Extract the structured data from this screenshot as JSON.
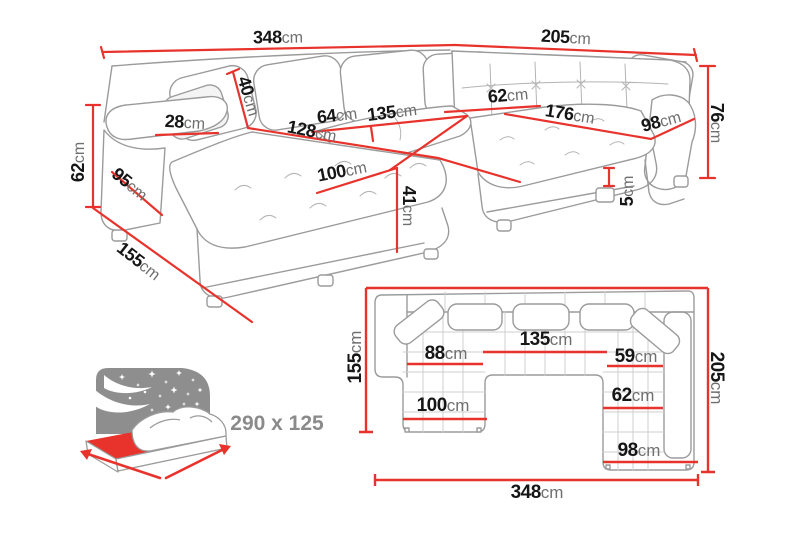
{
  "colors": {
    "dimension_red": "#e8332c",
    "number_text": "#161616",
    "unit_text": "#6f6f6f",
    "outline_gray": "#9b9b9b",
    "icon_gray": "#8e8e8e"
  },
  "perspective": {
    "width_left": {
      "num": "348",
      "unit": "cm"
    },
    "width_right": {
      "num": "205",
      "unit": "cm"
    },
    "back_height_right": {
      "num": "76",
      "unit": "cm"
    },
    "back_height_left": {
      "num": "62",
      "unit": "cm"
    },
    "armrest_depth": {
      "num": "95",
      "unit": "cm"
    },
    "chaise_side_depth": {
      "num": "155",
      "unit": "cm"
    },
    "armrest_width": {
      "num": "28",
      "unit": "cm"
    },
    "backrest_depth": {
      "num": "40",
      "unit": "cm"
    },
    "seat_width_small": {
      "num": "64",
      "unit": "cm"
    },
    "seat_width_center": {
      "num": "135",
      "unit": "cm"
    },
    "chaise_length": {
      "num": "128",
      "unit": "cm"
    },
    "chaise_width": {
      "num": "100",
      "unit": "cm"
    },
    "seat_height": {
      "num": "41",
      "unit": "cm"
    },
    "corner_seat_width": {
      "num": "62",
      "unit": "cm"
    },
    "right_seat_length": {
      "num": "176",
      "unit": "cm"
    },
    "right_seat_depth": {
      "num": "98",
      "unit": "cm"
    },
    "foot_height": {
      "num": "5",
      "unit": "cm"
    }
  },
  "plan": {
    "chaise_depth": {
      "num": "155",
      "unit": "cm"
    },
    "right_depth": {
      "num": "205",
      "unit": "cm"
    },
    "center_width": {
      "num": "135",
      "unit": "cm"
    },
    "left_seat_width": {
      "num": "88",
      "unit": "cm"
    },
    "right_seat_width": {
      "num": "59",
      "unit": "cm"
    },
    "chaise_width": {
      "num": "100",
      "unit": "cm"
    },
    "right_inner_width": {
      "num": "62",
      "unit": "cm"
    },
    "right_outer_width": {
      "num": "98",
      "unit": "cm"
    },
    "total_width": {
      "num": "348",
      "unit": "cm"
    }
  },
  "sleeping_area": {
    "size_label": "290 x 125"
  }
}
